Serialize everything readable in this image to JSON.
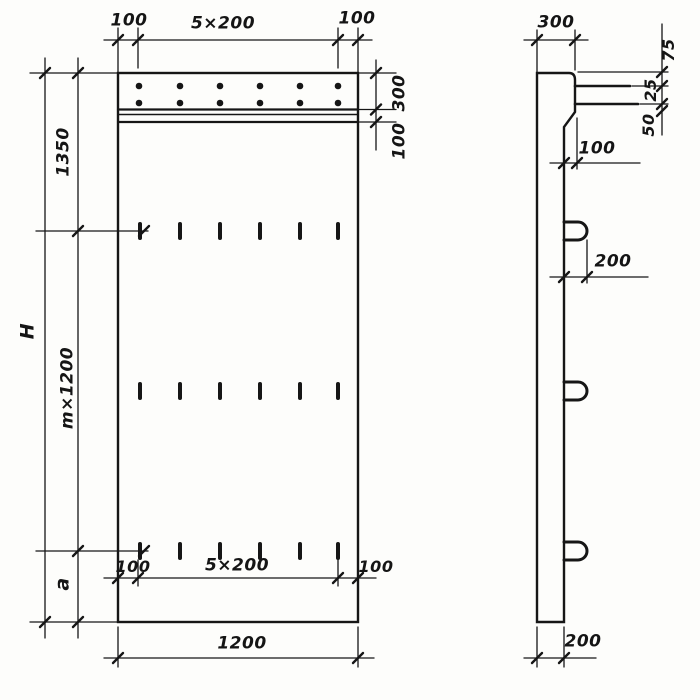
{
  "drawing": {
    "front": {
      "top_left": "100",
      "top_mid": "5×200",
      "top_right": "100",
      "band": "300",
      "strip": "100",
      "height_total": "H",
      "height_top": "1350",
      "height_mid": "m×1200",
      "height_bottom": "a",
      "bot_left": "100",
      "bot_mid": "5×200",
      "bot_right": "100",
      "width": "1200"
    },
    "side": {
      "top": "300",
      "bar_top": "75",
      "bar_mid": "25",
      "bar_bot": "50",
      "step": "100",
      "loop": "200",
      "thickness": "200"
    },
    "colors": {
      "ink": "#161616",
      "paper": "#fdfdfb"
    }
  }
}
